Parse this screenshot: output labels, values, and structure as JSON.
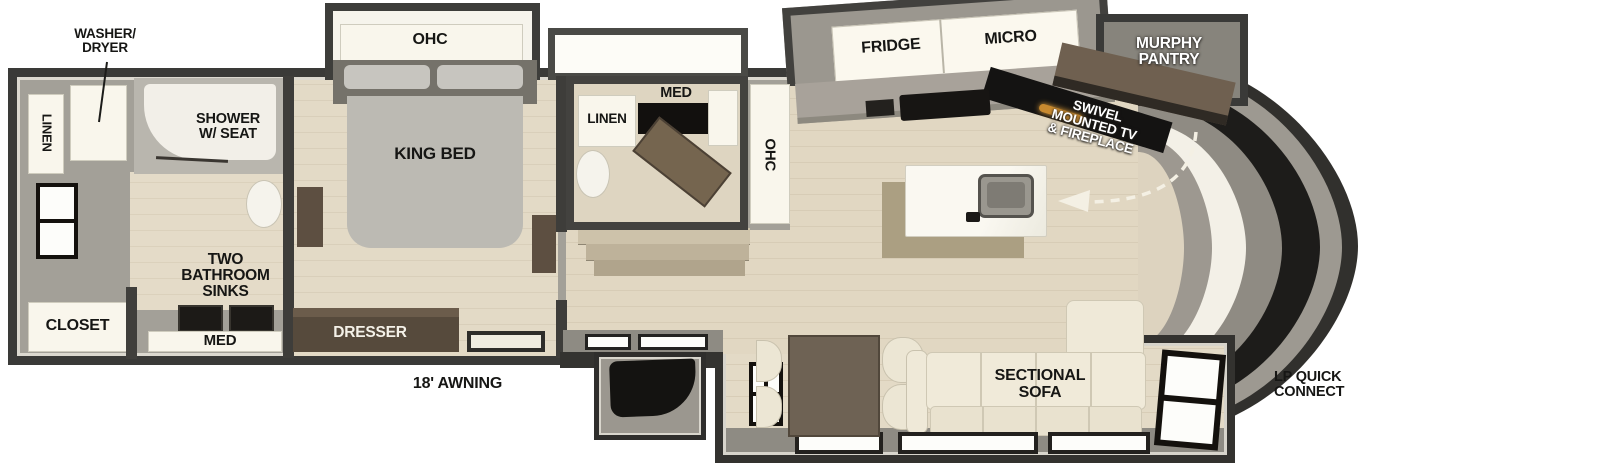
{
  "floorplan": {
    "rear_bath": {
      "washer_dryer": [
        "WASHER/",
        "DRYER"
      ],
      "linen": "LINEN",
      "shower": [
        "SHOWER",
        "W/ SEAT"
      ],
      "closet": "CLOSET",
      "two_bath_sinks": [
        "TWO",
        "BATHROOM",
        "SINKS"
      ],
      "med": "MED"
    },
    "bedroom": {
      "ohc": "OHC",
      "king_bed": "KING BED",
      "dresser": "DRESSER"
    },
    "mid_bath": {
      "linen": "LINEN",
      "med": "MED"
    },
    "kitchen": {
      "ohc": "OHC",
      "fridge": "FRIDGE",
      "micro": "MICRO",
      "murphy_pantry": [
        "MURPHY",
        "PANTRY"
      ],
      "swivel_tv": [
        "SWIVEL",
        "MOUNTED TV",
        "& FIREPLACE"
      ]
    },
    "living": {
      "sectional_sofa": [
        "SECTIONAL",
        "SOFA"
      ]
    },
    "exterior": {
      "awning": "18' AWNING",
      "lp_quick_connect": [
        "LP QUICK",
        "CONNECT"
      ]
    },
    "colors": {
      "outer_wall": "#3a3a38",
      "inner_wall_gray": "#8e8b83",
      "floor_beige": "#e0d6c1",
      "cabinet_white": "#f9f6ec",
      "furniture_brown": "#5d4f40",
      "bed_gray": "#bcbab3",
      "sofa_cream": "#efe9d8",
      "appliance_black": "#171513",
      "fireplace_amber": "#c98a2f"
    }
  }
}
